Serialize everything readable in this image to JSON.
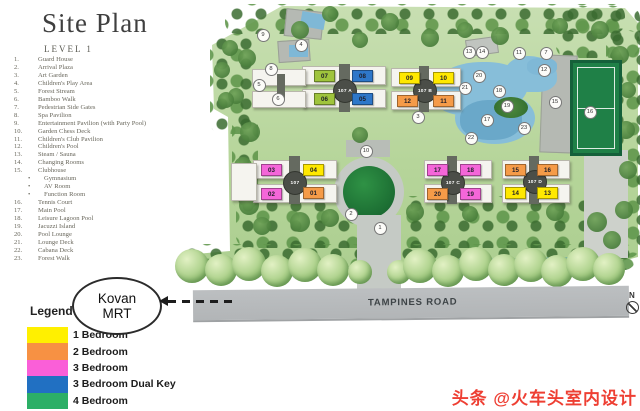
{
  "header": {
    "title": "Site Plan",
    "subtitle": "LEVEL 1"
  },
  "facilities": [
    {
      "num": "1.",
      "name": "Guard House"
    },
    {
      "num": "2.",
      "name": "Arrival Plaza"
    },
    {
      "num": "3.",
      "name": "Art Garden"
    },
    {
      "num": "4.",
      "name": "Children's Play Area"
    },
    {
      "num": "5.",
      "name": "Forest Stream"
    },
    {
      "num": "6.",
      "name": "Bamboo Walk"
    },
    {
      "num": "7.",
      "name": "Pedestrian Side Gates"
    },
    {
      "num": "8.",
      "name": "Spa Pavilion"
    },
    {
      "num": "9.",
      "name": "Entertainment Pavilion (with Party Pool)"
    },
    {
      "num": "10.",
      "name": "Garden Chess Deck"
    },
    {
      "num": "11.",
      "name": "Children's Club Pavilion"
    },
    {
      "num": "12.",
      "name": "Children's Pool"
    },
    {
      "num": "13.",
      "name": "Steam / Sauna"
    },
    {
      "num": "14.",
      "name": "Changing Rooms"
    },
    {
      "num": "15.",
      "name": "Clubhouse"
    },
    {
      "num": "•",
      "name": "Gymnasium",
      "sub": true
    },
    {
      "num": "•",
      "name": "AV Room",
      "sub": true
    },
    {
      "num": "•",
      "name": "Function Room",
      "sub": true
    },
    {
      "num": "16.",
      "name": "Tennis Court"
    },
    {
      "num": "17.",
      "name": "Main Pool"
    },
    {
      "num": "18.",
      "name": "Leisure Lagoon Pool"
    },
    {
      "num": "19.",
      "name": "Jacuzzi Island"
    },
    {
      "num": "20.",
      "name": "Pool Lounge"
    },
    {
      "num": "21.",
      "name": "Lounge Deck"
    },
    {
      "num": "22.",
      "name": "Cabana Deck"
    },
    {
      "num": "23.",
      "name": "Forest Walk"
    }
  ],
  "legend": {
    "title": "Legend",
    "items": [
      {
        "color": "#FFF000",
        "label": "1 Bedroom"
      },
      {
        "color": "#F79143",
        "label": "2 Bedroom"
      },
      {
        "color": "#FA5FD8",
        "label": "3 Bedroom"
      },
      {
        "color": "#2170C2",
        "label": "3 Bedroom Dual Key"
      },
      {
        "color": "#2CAF66",
        "label": "4 Bedroom"
      }
    ]
  },
  "mrt": {
    "line1": "Kovan",
    "line2": "MRT"
  },
  "road": {
    "name": "TAMPINES ROAD"
  },
  "compass": {
    "label": "N"
  },
  "watermark": {
    "text": "头条 @火车头室内设计"
  },
  "site_map": {
    "unit_colors": {
      "1br": "#FFE800",
      "2br": "#F59B48",
      "3br": "#F466D9",
      "3brdk": "#2E77C9",
      "4br": "#9FC43C"
    },
    "blocks": [
      {
        "label": "107 A",
        "cx": 344,
        "cy": 90,
        "slabs": [
          [
            302,
            66,
            82,
            17
          ],
          [
            302,
            89,
            82,
            17
          ],
          [
            252,
            69,
            52,
            15
          ],
          [
            252,
            91,
            52,
            15
          ]
        ],
        "cores": [
          [
            339,
            64,
            11,
            48
          ],
          [
            277,
            74,
            8,
            26
          ]
        ]
      },
      {
        "label": "107 B",
        "cx": 424,
        "cy": 90,
        "slabs": [
          [
            391,
            68,
            68,
            17
          ],
          [
            391,
            91,
            68,
            17
          ]
        ],
        "cores": [
          [
            419,
            66,
            10,
            46
          ]
        ]
      },
      {
        "label": "107",
        "cx": 294,
        "cy": 182,
        "slabs": [
          [
            253,
            160,
            82,
            17
          ],
          [
            253,
            184,
            82,
            17
          ],
          [
            231,
            163,
            24,
            36
          ]
        ],
        "cores": [
          [
            289,
            156,
            11,
            48
          ]
        ]
      },
      {
        "label": "107 C",
        "cx": 452,
        "cy": 182,
        "slabs": [
          [
            424,
            160,
            66,
            17
          ],
          [
            424,
            184,
            66,
            17
          ]
        ],
        "cores": [
          [
            447,
            156,
            10,
            48
          ]
        ]
      },
      {
        "label": "107 D",
        "cx": 534,
        "cy": 181,
        "slabs": [
          [
            502,
            160,
            66,
            17
          ],
          [
            502,
            184,
            66,
            17
          ]
        ],
        "cores": [
          [
            529,
            156,
            10,
            48
          ]
        ]
      }
    ],
    "units": [
      {
        "no": "07",
        "type": "4br",
        "x": 314,
        "y": 70
      },
      {
        "no": "08",
        "type": "3brdk",
        "x": 352,
        "y": 70
      },
      {
        "no": "06",
        "type": "4br",
        "x": 314,
        "y": 93
      },
      {
        "no": "05",
        "type": "3brdk",
        "x": 352,
        "y": 93
      },
      {
        "no": "09",
        "type": "1br",
        "x": 399,
        "y": 72
      },
      {
        "no": "10",
        "type": "1br",
        "x": 433,
        "y": 72
      },
      {
        "no": "12",
        "type": "2br",
        "x": 397,
        "y": 95
      },
      {
        "no": "11",
        "type": "2br",
        "x": 433,
        "y": 95
      },
      {
        "no": "03",
        "type": "3br",
        "x": 261,
        "y": 164
      },
      {
        "no": "04",
        "type": "1br",
        "x": 303,
        "y": 164
      },
      {
        "no": "02",
        "type": "3br",
        "x": 261,
        "y": 188
      },
      {
        "no": "01",
        "type": "2br",
        "x": 303,
        "y": 187
      },
      {
        "no": "17",
        "type": "3br",
        "x": 427,
        "y": 164
      },
      {
        "no": "18",
        "type": "3br",
        "x": 460,
        "y": 164
      },
      {
        "no": "20",
        "type": "2br",
        "x": 427,
        "y": 188
      },
      {
        "no": "19",
        "type": "3br",
        "x": 460,
        "y": 188
      },
      {
        "no": "15",
        "type": "2br",
        "x": 505,
        "y": 164
      },
      {
        "no": "16",
        "type": "2br",
        "x": 537,
        "y": 164
      },
      {
        "no": "14",
        "type": "1br",
        "x": 505,
        "y": 187
      },
      {
        "no": "13",
        "type": "1br",
        "x": 537,
        "y": 187
      }
    ],
    "markers": [
      {
        "n": "1",
        "x": 379,
        "y": 227
      },
      {
        "n": "2",
        "x": 350,
        "y": 213
      },
      {
        "n": "3",
        "x": 417,
        "y": 116
      },
      {
        "n": "4",
        "x": 300,
        "y": 44
      },
      {
        "n": "5",
        "x": 258,
        "y": 84
      },
      {
        "n": "6",
        "x": 277,
        "y": 98
      },
      {
        "n": "7",
        "x": 545,
        "y": 52
      },
      {
        "n": "8",
        "x": 270,
        "y": 68
      },
      {
        "n": "9",
        "x": 262,
        "y": 34
      },
      {
        "n": "10",
        "x": 365,
        "y": 150
      },
      {
        "n": "11",
        "x": 518,
        "y": 52
      },
      {
        "n": "12",
        "x": 543,
        "y": 69
      },
      {
        "n": "13",
        "x": 468,
        "y": 51
      },
      {
        "n": "14",
        "x": 481,
        "y": 51
      },
      {
        "n": "15",
        "x": 554,
        "y": 101
      },
      {
        "n": "16",
        "x": 589,
        "y": 111
      },
      {
        "n": "17",
        "x": 486,
        "y": 119
      },
      {
        "n": "18",
        "x": 498,
        "y": 90
      },
      {
        "n": "19",
        "x": 506,
        "y": 105
      },
      {
        "n": "20",
        "x": 478,
        "y": 75
      },
      {
        "n": "21",
        "x": 464,
        "y": 87
      },
      {
        "n": "22",
        "x": 470,
        "y": 137
      },
      {
        "n": "23",
        "x": 523,
        "y": 127
      }
    ]
  }
}
